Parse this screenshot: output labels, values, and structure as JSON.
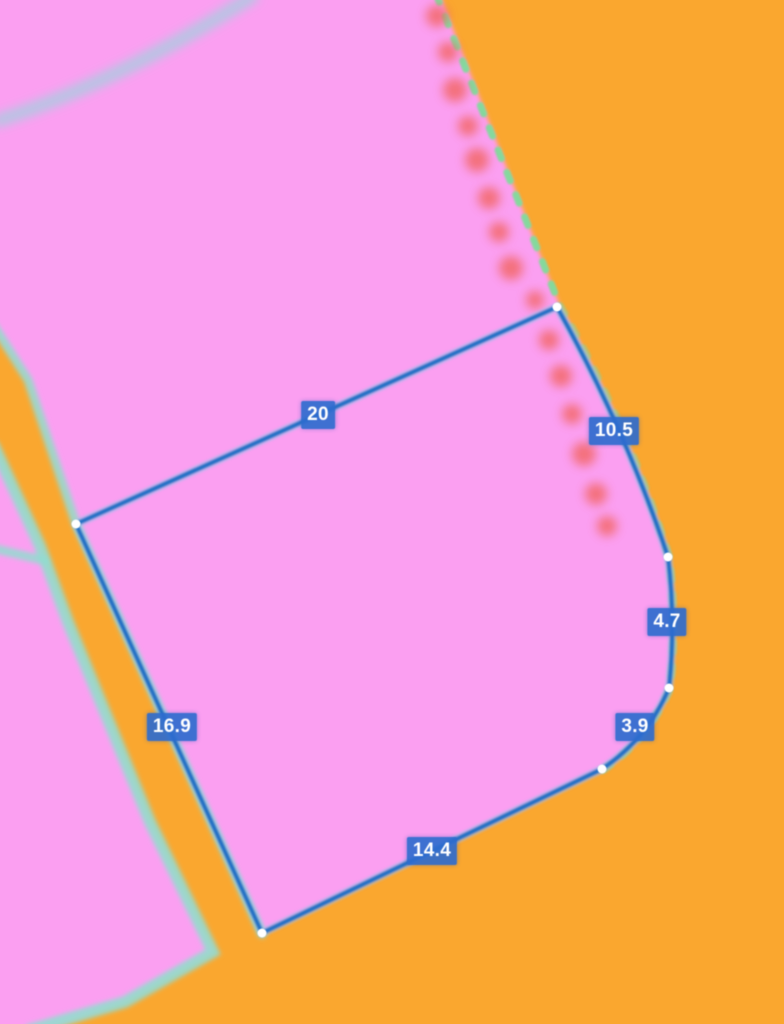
{
  "map": {
    "background_color": "#FAA72F",
    "parcel_color": "#FB9FF1",
    "parcel_edge_color": "#93DCD0",
    "inner_boundary_color": "#9ED3DE",
    "boundary_dash_color": "#7EDB9C",
    "vegetation_color": "#F2635C",
    "measure_line_color": "#2170C4",
    "vertex_color": "#FFFFFF",
    "label_bg_color": "#2E6BCE",
    "label_text_color": "#FFFFFF"
  },
  "measurements": {
    "top": {
      "value": "20"
    },
    "right_upper": {
      "value": "10.5"
    },
    "right": {
      "value": "4.7"
    },
    "right_lower": {
      "value": "3.9"
    },
    "bottom": {
      "value": "14.4"
    },
    "left": {
      "value": "16.9"
    }
  }
}
